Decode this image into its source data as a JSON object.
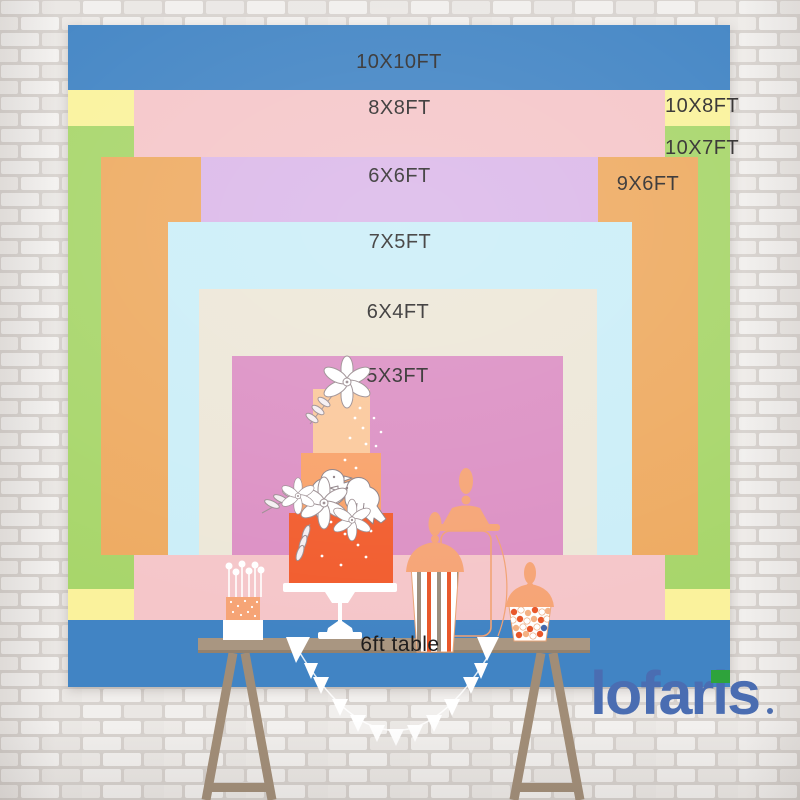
{
  "backdrop": {
    "description_labels": true,
    "layers": [
      {
        "label": "10X10FT",
        "width_ft": 10,
        "height_ft": 10,
        "color": "#4184C4"
      },
      {
        "label": "10X8FT",
        "width_ft": 10,
        "height_ft": 8,
        "color": "#FAF29C"
      },
      {
        "label": "10X7FT",
        "width_ft": 10,
        "height_ft": 7,
        "color": "#A8D66B"
      },
      {
        "label": "8X8FT",
        "width_ft": 8,
        "height_ft": 8,
        "color": "#F5C6C9"
      },
      {
        "label": "9X6FT",
        "width_ft": 9,
        "height_ft": 6,
        "color": "#EEAB62"
      },
      {
        "label": "6X6FT",
        "width_ft": 6,
        "height_ft": 6,
        "color": "#DBB8E9"
      },
      {
        "label": "7X5FT",
        "width_ft": 7,
        "height_ft": 5,
        "color": "#CBEEF8"
      },
      {
        "label": "6X4FT",
        "width_ft": 6,
        "height_ft": 4,
        "color": "#EDE7D8"
      },
      {
        "label": "5X3FT",
        "width_ft": 5,
        "height_ft": 3,
        "color": "#DC90C4"
      }
    ]
  },
  "table": {
    "label": "6ft table",
    "surface_color": "#A99681",
    "leg_color": "#A18D77"
  },
  "logo": {
    "text": "lofaris",
    "color": "#4A6DB2",
    "accent_color": "#2EA33B"
  },
  "wall": {
    "style": "white painted brick",
    "base_color": "#ece9e6",
    "mortar_color": "#d7d2ce"
  },
  "decor": {
    "items": [
      "three-tier-cake",
      "cake-pop-stand",
      "apothecary-jar",
      "popcorn-striped-jar",
      "candy-jar",
      "bunting-garland",
      "trestle-table"
    ],
    "cake_tier_colors": [
      "#FBC89B",
      "#F9A168",
      "#F25C2D"
    ],
    "jar_lid_color": "#F6A475",
    "accent_orange": "#E8572A"
  }
}
